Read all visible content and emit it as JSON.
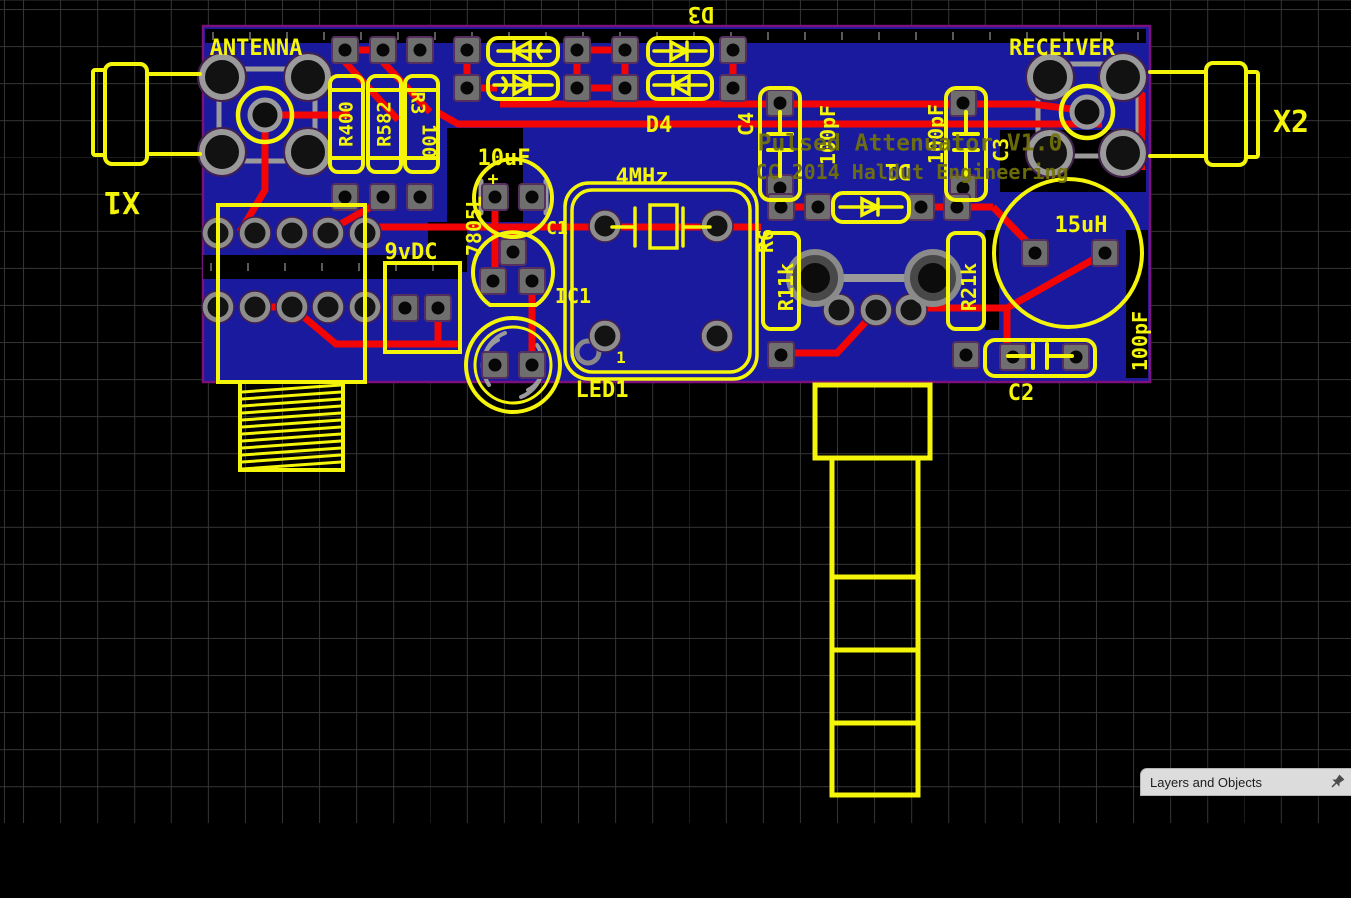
{
  "canvas": {
    "type": "pcb-editor-canvas",
    "grid_visible": true
  },
  "colors": {
    "board_substrate": "#1a1a9e",
    "board_outline": "#7c107c",
    "silkscreen": "#f5f50a",
    "dim_silkscreen": "#73730a",
    "copper_trace": "#f30505",
    "pad_gray": "#6f6f6f",
    "grid_line": "#343434"
  },
  "pcb": {
    "title_text": {
      "line1": "Pulsed Attenuator V1.0",
      "line2": "CC 2014 Haldut Engineering"
    },
    "silk_labels": [
      {
        "name": "antenna-label",
        "text": "ANTENNA",
        "x": 256,
        "y": 49,
        "size": 22,
        "rot": 0,
        "cls": "silk"
      },
      {
        "name": "receiver-label",
        "text": "RECEIVER",
        "x": 1062,
        "y": 49,
        "size": 22,
        "rot": 0,
        "cls": "silk"
      },
      {
        "name": "x1-label",
        "text": "X1",
        "x": 122,
        "y": 201,
        "size": 30,
        "rot": 180,
        "cls": "silk"
      },
      {
        "name": "x2-label",
        "text": "X2",
        "x": 1291,
        "y": 123,
        "size": 30,
        "rot": 0,
        "cls": "silk"
      },
      {
        "name": "d3-label",
        "text": "D3",
        "x": 701,
        "y": 13,
        "size": 22,
        "rot": 180,
        "cls": "silk"
      },
      {
        "name": "d4-label",
        "text": "D4",
        "x": 659,
        "y": 126,
        "size": 22,
        "rot": 0,
        "cls": "silk"
      },
      {
        "name": "c4-label",
        "text": "C4",
        "x": 746,
        "y": 124,
        "size": 20,
        "rot": -90,
        "cls": "silk"
      },
      {
        "name": "c4-value",
        "text": "100pF",
        "x": 828,
        "y": 135,
        "size": 20,
        "rot": -90,
        "cls": "silk"
      },
      {
        "name": "c3-value",
        "text": "100pF",
        "x": 936,
        "y": 134,
        "size": 20,
        "rot": -90,
        "cls": "silk"
      },
      {
        "name": "c3-label",
        "text": "C3",
        "x": 1001,
        "y": 150,
        "size": 20,
        "rot": -90,
        "cls": "silk"
      },
      {
        "name": "l1-value",
        "text": "15uH",
        "x": 1081,
        "y": 226,
        "size": 22,
        "rot": 0,
        "cls": "silk"
      },
      {
        "name": "d1-label",
        "text": "D1",
        "x": 898,
        "y": 170,
        "size": 22,
        "rot": 180,
        "cls": "silk"
      },
      {
        "name": "r6-label",
        "text": "R6",
        "x": 766,
        "y": 241,
        "size": 20,
        "rot": -90,
        "cls": "silk"
      },
      {
        "name": "r1-label",
        "text": "R11k",
        "x": 786,
        "y": 287,
        "size": 20,
        "rot": -90,
        "cls": "silk"
      },
      {
        "name": "r2-label",
        "text": "R21k",
        "x": 969,
        "y": 287,
        "size": 20,
        "rot": -90,
        "cls": "silk"
      },
      {
        "name": "c2-label",
        "text": "C2",
        "x": 1021,
        "y": 394,
        "size": 22,
        "rot": 0,
        "cls": "silk"
      },
      {
        "name": "c2-value",
        "text": "100pF",
        "x": 1140,
        "y": 341,
        "size": 20,
        "rot": -90,
        "cls": "silk"
      },
      {
        "name": "power-label",
        "text": "9vDC",
        "x": 411,
        "y": 253,
        "size": 22,
        "rot": 0,
        "cls": "silk"
      },
      {
        "name": "c5-value",
        "text": "10uF",
        "x": 504,
        "y": 159,
        "size": 22,
        "rot": 0,
        "cls": "silk"
      },
      {
        "name": "c5-plus",
        "text": "+",
        "x": 493,
        "y": 180,
        "size": 18,
        "rot": 0,
        "cls": "silk"
      },
      {
        "name": "vreg-value",
        "text": "7805L",
        "x": 474,
        "y": 226,
        "size": 20,
        "rot": -90,
        "cls": "silk"
      },
      {
        "name": "ic1-label",
        "text": "IC1",
        "x": 573,
        "y": 296,
        "size": 20,
        "rot": 0,
        "cls": "silk"
      },
      {
        "name": "c1-label",
        "text": "C1",
        "x": 557,
        "y": 229,
        "size": 18,
        "rot": 0,
        "cls": "silk"
      },
      {
        "name": "led1-label",
        "text": "LED1",
        "x": 602,
        "y": 391,
        "size": 22,
        "rot": 0,
        "cls": "silk"
      },
      {
        "name": "xtal-value",
        "text": "4MHz",
        "x": 642,
        "y": 178,
        "size": 22,
        "rot": 0,
        "cls": "silk"
      },
      {
        "name": "pin1-label",
        "text": "1",
        "x": 621,
        "y": 358,
        "size": 16,
        "rot": 0,
        "cls": "silk"
      },
      {
        "name": "r4-label",
        "text": "R400",
        "x": 347,
        "y": 124,
        "size": 19,
        "rot": -90,
        "cls": "silk"
      },
      {
        "name": "r5-label",
        "text": "R582",
        "x": 385,
        "y": 124,
        "size": 19,
        "rot": -90,
        "cls": "silk"
      },
      {
        "name": "r3-label",
        "text": "R3",
        "x": 417,
        "y": 103,
        "size": 19,
        "rot": 90,
        "cls": "silk"
      },
      {
        "name": "r3-value",
        "text": "100",
        "x": 428,
        "y": 141,
        "size": 19,
        "rot": 90,
        "cls": "silk"
      },
      {
        "name": "board-title-line1",
        "text": "Pulsed Attenuator V1.0",
        "x": 910,
        "y": 144,
        "size": 23,
        "rot": 0,
        "cls": "dim"
      },
      {
        "name": "board-title-line2",
        "text": "CC 2014 Haldut Engineering",
        "x": 912,
        "y": 172,
        "size": 20,
        "rot": 0,
        "cls": "dim"
      }
    ]
  },
  "panel": {
    "title": "Layers and Objects",
    "pin_icon": "pushpin-icon"
  }
}
